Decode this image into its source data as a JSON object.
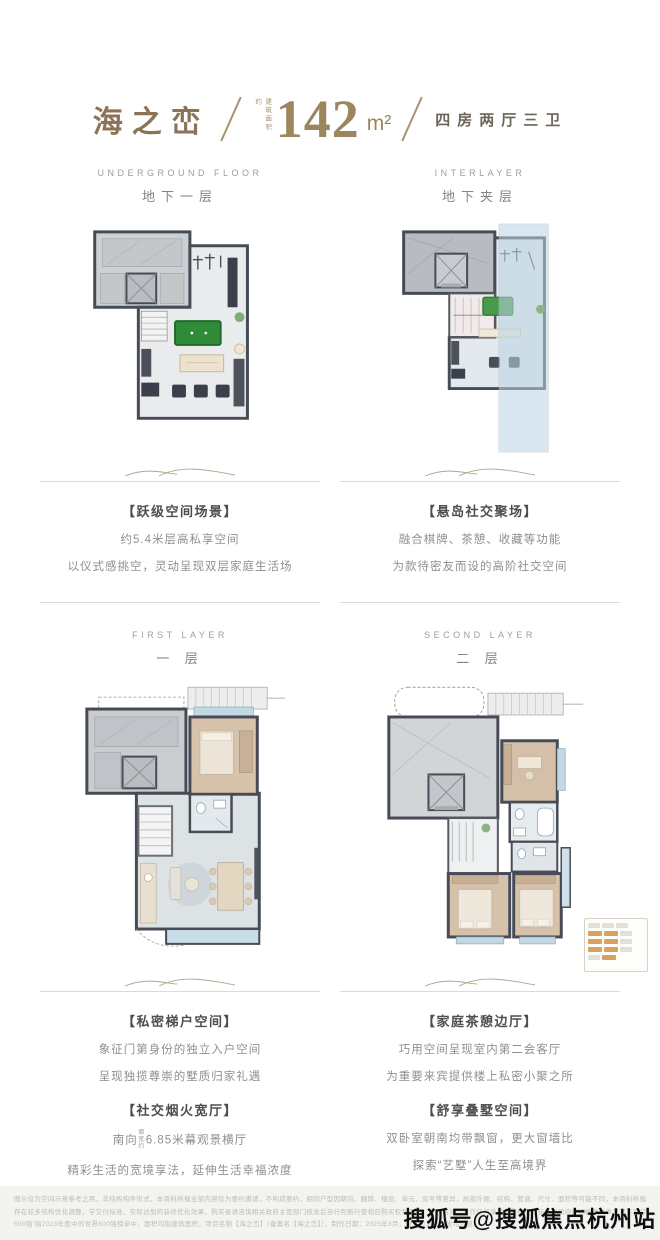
{
  "header": {
    "brand": "海之峦",
    "area_prefix": "建筑面积约",
    "area_value": "142",
    "area_unit": "m²",
    "layout_label": "四房两厅三卫"
  },
  "floors": {
    "underground": {
      "title_en": "UNDERGROUND FLOOR",
      "title_cn": "地下一层",
      "caption_title": "【跃级空间场景】",
      "caption_line1": "约5.4米层高私享空间",
      "caption_line2": "以仪式感挑空，灵动呈现双层家庭生活场"
    },
    "interlayer": {
      "title_en": "INTERLAYER",
      "title_cn": "地下夹层",
      "caption_title": "【悬岛社交聚场】",
      "caption_line1": "融合棋牌、茶憩、收藏等功能",
      "caption_line2": "为款待密友而设的高阶社交空间"
    },
    "first": {
      "title_en": "FIRST LAYER",
      "title_cn": "一 层",
      "captions": [
        {
          "title": "【私密梯户空间】",
          "line1": "象征门第身份的独立入户空间",
          "line2": "呈现独揽尊崇的墅质归家礼遇"
        },
        {
          "title": "【社交烟火宽厅】",
          "line1_prefix": "南向",
          "line1_small": "面宽约",
          "line1_rest": "6.85米幕观景横厅",
          "line2": "精彩生活的宽境享法，延伸生活幸福浓度"
        }
      ]
    },
    "second": {
      "title_en": "SECOND LAYER",
      "title_cn": "二 层",
      "captions": [
        {
          "title": "【家庭茶憩边厅】",
          "line1": "巧用空间呈现室内第二会客厅",
          "line2": "为重要来宾提供楼上私密小聚之所"
        },
        {
          "title": "【舒享叠墅空间】",
          "line1": "双卧室朝南均带飘窗，更大窗墙比",
          "line2": "探索“艺墅”人生至高境界"
        }
      ]
    }
  },
  "footer": {
    "line1": "图示仅为空间示意参考之用，非结构构件形式，本资料所载全部内容仅为要约邀请，不构成要约，相同户型因朝向、翻转、楼层、单元、房号等差异，局部外观、结构、管道、尺寸、面积等可能不同，本资料所载示意图仅供空间优化方案参考，",
    "line2": "存在较多结构优化调整，学交付标准、实际达到的装修优化效果，购买者请咨询相关政府主管部门核准后自行判断行使相应购买权利不同，开发商对此不作任何承诺，最终交付标准以政府部门核准文件及双方签订的《商品房买卖合同》为准，“世界",
    "line3": "500强”指2023年度中的世界500强榜单中，面积均指建筑面积，项目名称【海之峦】（备案名【海之峦】），制作日期：2025年3月，敬请留意最新发布信息。"
  },
  "watermark": "搜狐号@搜狐焦点杭州站",
  "colors": {
    "brand_bronze": "#8a7357",
    "area_gold": "#9c8660",
    "wall": "#464b55",
    "void_blue": "#bcd4e4",
    "wood_tan": "#d6c1aa",
    "billiard_green": "#2f8b37"
  }
}
